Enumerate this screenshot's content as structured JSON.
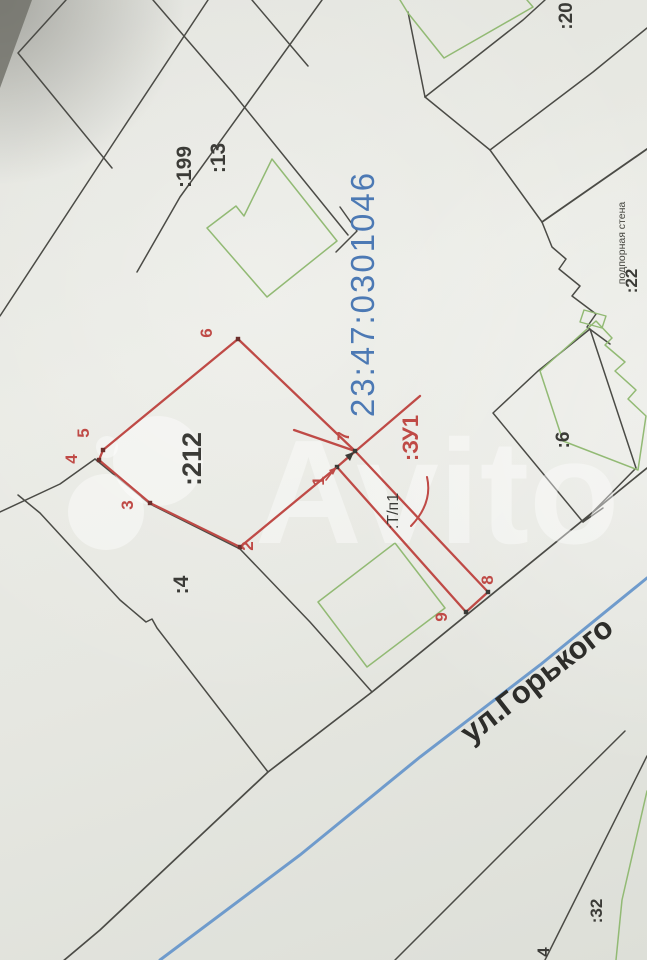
{
  "meta": {
    "description": "Photographed cadastral plan scheme (land survey map) with plot :ЗУ1 outlined in red",
    "cadastral_quarter": "23:47:0301046",
    "street_name": "ул.Горького",
    "new_plot_label": ":ЗУ1",
    "outbuilding_label": ":Т/п1",
    "retaining_wall_label": "подпорная стена",
    "parcel_numbers": [
      ":199",
      ":13",
      ":212",
      ":4",
      ":6",
      ":20",
      ":22",
      ":32"
    ],
    "red_vertex_numbers": [
      "1",
      "2",
      "3",
      "4",
      "5",
      "6",
      "7",
      "8",
      "9"
    ]
  },
  "colors": {
    "red": "#bf4a46",
    "red_dark": "#8a3431",
    "green": "#92ba74",
    "blue_line": "#6f9bcc",
    "blue_text": "#4c79b4",
    "black_line": "#4b4b46",
    "black_text": "#3b3b37",
    "street_text": "#2d2d2a",
    "watermark": "#ffffff"
  },
  "watermark": {
    "text": "Avito",
    "text_x": 255,
    "text_y": 543,
    "text_size": 148,
    "opacity": 0.42,
    "circles": [
      {
        "name": "avito-logo-circle-small",
        "cx": 107,
        "cy": 447,
        "r": 11
      },
      {
        "name": "avito-logo-circle-large",
        "cx": 158,
        "cy": 461,
        "r": 45
      },
      {
        "name": "avito-logo-circle-medium",
        "cx": 106,
        "cy": 512,
        "r": 38
      }
    ]
  },
  "labels": [
    {
      "name": "parcel-label-199",
      "text": ":199",
      "x": 191,
      "y": 167,
      "rot": -90,
      "size": 21,
      "color": "#3b3b37",
      "weight": 600
    },
    {
      "name": "parcel-label-13",
      "text": ":13",
      "x": 225,
      "y": 158,
      "rot": -90,
      "size": 21,
      "color": "#3b3b37",
      "weight": 600
    },
    {
      "name": "parcel-label-212",
      "text": ":212",
      "x": 201,
      "y": 459,
      "rot": -90,
      "size": 27,
      "color": "#3b3b37",
      "weight": 600
    },
    {
      "name": "parcel-label-4",
      "text": ":4",
      "x": 188,
      "y": 585,
      "rot": -90,
      "size": 21,
      "color": "#3b3b37",
      "weight": 600
    },
    {
      "name": "parcel-label-6",
      "text": ":6",
      "x": 569,
      "y": 440,
      "rot": -90,
      "size": 19,
      "color": "#3b3b37",
      "weight": 600
    },
    {
      "name": "parcel-label-20",
      "text": ":20",
      "x": 572,
      "y": 16,
      "rot": -90,
      "size": 19,
      "color": "#3b3b37",
      "weight": 600
    },
    {
      "name": "parcel-label-22",
      "text": ":22",
      "x": 637,
      "y": 281,
      "rot": -90,
      "size": 17,
      "color": "#3b3b37",
      "weight": 600
    },
    {
      "name": "retaining-wall-label",
      "text": "подпорная стена",
      "x": 625,
      "y": 243,
      "rot": -90,
      "size": 10.5,
      "color": "#45453f",
      "weight": 400
    },
    {
      "name": "parcel-label-32",
      "text": ":32",
      "x": 602,
      "y": 911,
      "rot": -90,
      "size": 17,
      "color": "#3b3b37",
      "weight": 600
    },
    {
      "name": "parcel-label-4b",
      "text": "4",
      "x": 549,
      "y": 952,
      "rot": -90,
      "size": 17,
      "color": "#3b3b37",
      "weight": 600
    },
    {
      "name": "street-name-label",
      "text": "ул.Горького",
      "x": 543,
      "y": 688,
      "rot": -38,
      "size": 31,
      "color": "#2d2d2a",
      "weight": 600
    },
    {
      "name": "cadastral-quarter-label",
      "text": "23:47:0301046",
      "x": 374,
      "y": 294,
      "rot": -90,
      "size": 33,
      "color": "#4c79b4",
      "weight": 400,
      "ls": 2
    },
    {
      "name": "outbuilding-label",
      "text": ":Т/п1",
      "x": 398,
      "y": 511,
      "rot": -90,
      "size": 16,
      "color": "#3b3b37",
      "weight": 400
    },
    {
      "name": "new-plot-label",
      "text": ":ЗУ1",
      "x": 418,
      "y": 438,
      "rot": -90,
      "size": 22,
      "color": "#bf4a46",
      "weight": 700
    },
    {
      "name": "vertex-label-1",
      "text": "1",
      "x": 324,
      "y": 481,
      "rot": -90,
      "size": 17,
      "color": "#bf4a46",
      "weight": 600
    },
    {
      "name": "vertex-label-2",
      "text": "2",
      "x": 253,
      "y": 546,
      "rot": -90,
      "size": 17,
      "color": "#bf4a46",
      "weight": 600
    },
    {
      "name": "vertex-label-3",
      "text": "3",
      "x": 133,
      "y": 505,
      "rot": -90,
      "size": 17,
      "color": "#bf4a46",
      "weight": 600
    },
    {
      "name": "vertex-label-4",
      "text": "4",
      "x": 77,
      "y": 459,
      "rot": -90,
      "size": 17,
      "color": "#bf4a46",
      "weight": 600
    },
    {
      "name": "vertex-label-5",
      "text": "5",
      "x": 89,
      "y": 433,
      "rot": -90,
      "size": 17,
      "color": "#bf4a46",
      "weight": 600
    },
    {
      "name": "vertex-label-6",
      "text": "6",
      "x": 212,
      "y": 333,
      "rot": -90,
      "size": 17,
      "color": "#bf4a46",
      "weight": 600
    },
    {
      "name": "vertex-label-7",
      "text": "7",
      "x": 349,
      "y": 436,
      "rot": -90,
      "size": 17,
      "color": "#bf4a46",
      "weight": 600
    },
    {
      "name": "vertex-label-8",
      "text": "8",
      "x": 493,
      "y": 580,
      "rot": -90,
      "size": 17,
      "color": "#bf4a46",
      "weight": 600
    },
    {
      "name": "vertex-label-9",
      "text": "9",
      "x": 447,
      "y": 617,
      "rot": -90,
      "size": 17,
      "color": "#bf4a46",
      "weight": 600
    }
  ],
  "black_lines": [
    {
      "name": "boundary-topleft-corner",
      "w": 1.5,
      "points": [
        [
          66,
          0
        ],
        [
          18,
          53
        ],
        [
          112,
          168
        ]
      ]
    },
    {
      "name": "boundary-199-left",
      "w": 1.5,
      "points": [
        [
          208,
          0
        ],
        [
          120,
          133
        ],
        [
          0,
          316
        ]
      ]
    },
    {
      "name": "boundary-199-right",
      "w": 1.5,
      "points": [
        [
          322,
          0
        ],
        [
          250,
          100
        ],
        [
          180,
          197
        ],
        [
          137,
          272
        ]
      ]
    },
    {
      "name": "boundary-13-right",
      "w": 1.5,
      "points": [
        [
          153,
          0
        ],
        [
          233,
          93
        ],
        [
          348,
          235
        ]
      ]
    },
    {
      "name": "boundary-corner-mid",
      "w": 1.5,
      "points": [
        [
          340,
          207
        ],
        [
          357,
          231
        ],
        [
          336,
          252
        ]
      ]
    },
    {
      "name": "boundary-top-short",
      "w": 1.5,
      "points": [
        [
          252,
          0
        ],
        [
          308,
          66
        ]
      ]
    },
    {
      "name": "boundary-topright-a",
      "w": 1.5,
      "points": [
        [
          408,
          12
        ],
        [
          425,
          97
        ]
      ]
    },
    {
      "name": "boundary-topright-b",
      "w": 1.5,
      "points": [
        [
          545,
          0
        ],
        [
          523,
          20
        ],
        [
          425,
          97
        ]
      ]
    },
    {
      "name": "boundary-topright-c",
      "w": 1.5,
      "points": [
        [
          425,
          97
        ],
        [
          490,
          150
        ]
      ]
    },
    {
      "name": "boundary-topright-d",
      "w": 1.5,
      "points": [
        [
          647,
          28
        ],
        [
          593,
          72
        ],
        [
          490,
          150
        ]
      ]
    },
    {
      "name": "boundary-topright-e",
      "w": 1.5,
      "points": [
        [
          490,
          150
        ],
        [
          542,
          222
        ]
      ]
    },
    {
      "name": "retaining-wall-line",
      "w": 1.8,
      "points": [
        [
          542,
          222
        ],
        [
          647,
          149
        ]
      ]
    },
    {
      "name": "building-stepped-right",
      "w": 1.5,
      "points": [
        [
          542,
          222
        ],
        [
          552,
          247
        ],
        [
          566,
          259
        ],
        [
          559,
          269
        ],
        [
          580,
          286
        ],
        [
          572,
          296
        ],
        [
          596,
          314
        ],
        [
          587,
          327
        ],
        [
          610,
          344
        ]
      ]
    },
    {
      "name": "parcel-6-boundary",
      "w": 1.5,
      "closed": true,
      "points": [
        [
          493,
          413
        ],
        [
          538,
          371
        ],
        [
          590,
          329
        ],
        [
          636,
          468
        ],
        [
          583,
          522
        ]
      ]
    },
    {
      "name": "parcel-6-connector",
      "w": 1.5,
      "points": [
        [
          583,
          522
        ],
        [
          603,
          508
        ]
      ]
    },
    {
      "name": "road-edge-long",
      "w": 1.7,
      "points": [
        [
          647,
          468
        ],
        [
          372,
          692
        ],
        [
          268,
          772
        ],
        [
          100,
          930
        ],
        [
          62,
          962
        ]
      ]
    },
    {
      "name": "boundary-below-2",
      "w": 1.5,
      "points": [
        [
          240,
          549
        ],
        [
          310,
          622
        ],
        [
          372,
          692
        ]
      ]
    },
    {
      "name": "parcel-4-southeast",
      "w": 1.5,
      "points": [
        [
          18,
          495
        ],
        [
          40,
          513
        ],
        [
          120,
          600
        ],
        [
          146,
          622
        ],
        [
          152,
          619
        ],
        [
          157,
          628
        ],
        [
          268,
          772
        ]
      ]
    },
    {
      "name": "parcel-4-west",
      "w": 1.5,
      "points": [
        [
          0,
          512
        ],
        [
          60,
          484
        ],
        [
          95,
          459
        ]
      ]
    },
    {
      "name": "parcel-212-south",
      "w": 1.5,
      "points": [
        [
          95,
          459
        ],
        [
          150,
          504
        ],
        [
          240,
          549
        ]
      ]
    },
    {
      "name": "road-edge-bottomright-a",
      "w": 1.5,
      "points": [
        [
          625,
          731
        ],
        [
          495,
          860
        ],
        [
          395,
          960
        ]
      ]
    },
    {
      "name": "road-edge-bottomright-b",
      "w": 1.5,
      "points": [
        [
          647,
          756
        ],
        [
          545,
          960
        ]
      ]
    },
    {
      "name": "arrow-line-7",
      "w": 1.4,
      "points": [
        [
          337,
          467
        ],
        [
          352,
          453
        ]
      ]
    }
  ],
  "green_lines": [
    {
      "name": "building-top-green",
      "w": 1.5,
      "points": [
        [
          400,
          0
        ],
        [
          408,
          13
        ],
        [
          444,
          58
        ],
        [
          533,
          7
        ],
        [
          527,
          0
        ]
      ]
    },
    {
      "name": "building-13-green",
      "w": 1.5,
      "closed": true,
      "points": [
        [
          272,
          159
        ],
        [
          337,
          241
        ],
        [
          267,
          297
        ],
        [
          207,
          228
        ],
        [
          236,
          206
        ],
        [
          244,
          216
        ]
      ]
    },
    {
      "name": "building-garden-green",
      "w": 1.5,
      "closed": true,
      "points": [
        [
          395,
          543
        ],
        [
          445,
          608
        ],
        [
          367,
          667
        ],
        [
          318,
          602
        ]
      ]
    },
    {
      "name": "building-tiny-green",
      "w": 1.4,
      "closed": true,
      "points": [
        [
          584,
          310
        ],
        [
          606,
          316
        ],
        [
          602,
          328
        ],
        [
          580,
          322
        ]
      ]
    },
    {
      "name": "building-6-green",
      "w": 1.5,
      "closed": true,
      "points": [
        [
          540,
          371
        ],
        [
          596,
          321
        ],
        [
          612,
          338
        ],
        [
          605,
          345
        ],
        [
          625,
          362
        ],
        [
          615,
          371
        ],
        [
          636,
          390
        ],
        [
          628,
          399
        ],
        [
          646,
          416
        ],
        [
          638,
          470
        ],
        [
          563,
          441
        ]
      ]
    },
    {
      "name": "green-line-bottomright",
      "w": 1.5,
      "points": [
        [
          647,
          791
        ],
        [
          622,
          900
        ],
        [
          616,
          960
        ]
      ]
    }
  ],
  "red_lines": [
    {
      "name": "plot-zu1-outline",
      "w": 2.3,
      "closed": true,
      "points": [
        [
          337,
          467
        ],
        [
          240,
          547
        ],
        [
          150,
          503
        ],
        [
          99,
          460
        ],
        [
          103,
          450
        ],
        [
          238,
          339
        ],
        [
          355,
          451
        ],
        [
          488,
          592
        ],
        [
          466,
          612
        ]
      ]
    },
    {
      "name": "plot-zu1-spur-upper",
      "w": 2.3,
      "points": [
        [
          420,
          396
        ],
        [
          337,
          467
        ]
      ]
    },
    {
      "name": "plot-zu1-spur-left",
      "w": 2.3,
      "points": [
        [
          294,
          430
        ],
        [
          355,
          451
        ]
      ]
    },
    {
      "name": "label-1-leader",
      "w": 1.6,
      "points": [
        [
          326,
          480
        ],
        [
          333,
          471
        ]
      ]
    }
  ],
  "red_curves": [
    {
      "name": "zu1-leader-arc",
      "w": 2,
      "d": "M 427,477 Q 433,503 411,526"
    }
  ],
  "blue_street": {
    "name": "street-axis-line",
    "w": 3,
    "points": [
      [
        160,
        960
      ],
      [
        300,
        855
      ],
      [
        420,
        757
      ],
      [
        540,
        665
      ],
      [
        647,
        578
      ]
    ]
  },
  "vertex_dots": [
    {
      "name": "vertex-dot-1",
      "x": 337,
      "y": 467,
      "color": "#3a3a36"
    },
    {
      "name": "vertex-dot-2",
      "x": 240,
      "y": 547,
      "color": "#6d2f2c"
    },
    {
      "name": "vertex-dot-3",
      "x": 150,
      "y": 503,
      "color": "#6d2f2c"
    },
    {
      "name": "vertex-dot-4",
      "x": 99,
      "y": 460,
      "color": "#6d2f2c"
    },
    {
      "name": "vertex-dot-5",
      "x": 103,
      "y": 450,
      "color": "#6d2f2c"
    },
    {
      "name": "vertex-dot-6",
      "x": 238,
      "y": 339,
      "color": "#6d2f2c"
    },
    {
      "name": "vertex-dot-7",
      "x": 355,
      "y": 451,
      "color": "#3a3a36"
    },
    {
      "name": "vertex-dot-8",
      "x": 488,
      "y": 592,
      "color": "#3a3a36"
    },
    {
      "name": "vertex-dot-9",
      "x": 466,
      "y": 612,
      "color": "#3a3a36"
    }
  ],
  "triangles": [
    {
      "name": "arrowhead-7",
      "points": "354,452 345,455 350,461",
      "color": "#3a3a36"
    },
    {
      "name": "arrowhead-1",
      "points": "337,467 329,470 333,475",
      "color": "#bf4a46"
    }
  ],
  "photo_corner": {
    "name": "photo-dark-corner",
    "points": "0,0 32,0 0,88",
    "color": "#6e6e66",
    "opacity": 0.8
  }
}
